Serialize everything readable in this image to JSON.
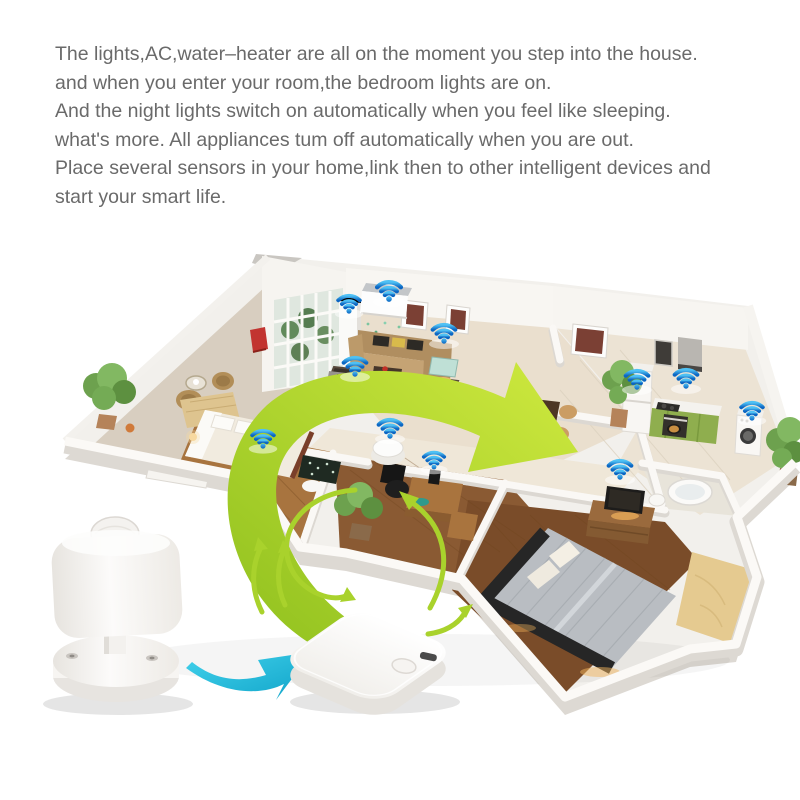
{
  "intro": {
    "lines": [
      "The lights,AC,water–heater are all on the moment you step into the house.",
      "and when you enter your room,the bedroom lights are on.",
      "And the night lights switch on automatically when you feel like sleeping.",
      "what's more. All appliances tum off automatically when you are out.",
      "Place several sensors in your home,link then to other intelligent devices and",
      "start your smart life."
    ]
  },
  "scene": {
    "colors": {
      "green_dark": "#8fc01e",
      "green_light": "#cfe93f",
      "green_stroke": "#a9d22c",
      "cyan_dark": "#0fa3c8",
      "cyan_light": "#43d2ec",
      "wifi_dark": "#0b66c3",
      "wifi_light": "#4fc1f4",
      "text_gray": "#6a6a6a"
    },
    "wifi_points": [
      {
        "x": 349,
        "y": 311,
        "s": 0.95
      },
      {
        "x": 389,
        "y": 299,
        "s": 1.05
      },
      {
        "x": 444,
        "y": 341,
        "s": 1.0
      },
      {
        "x": 355,
        "y": 374,
        "s": 1.0
      },
      {
        "x": 263,
        "y": 446,
        "s": 0.95
      },
      {
        "x": 390,
        "y": 436,
        "s": 1.0
      },
      {
        "x": 434,
        "y": 467,
        "s": 0.9
      },
      {
        "x": 637,
        "y": 387,
        "s": 1.0
      },
      {
        "x": 686,
        "y": 386,
        "s": 1.0
      },
      {
        "x": 752,
        "y": 418,
        "s": 0.95
      },
      {
        "x": 620,
        "y": 477,
        "s": 1.0
      }
    ],
    "icons": {
      "wifi": "wifi-signal-icon",
      "sensor": "pir-motion-sensor-device",
      "hub": "smart-gateway-hub-device",
      "arrow_big": "green-arrow-to-dining",
      "arrow_office": "green-arrow-to-office",
      "arrow_loop": "green-loop-arrow-hub",
      "arrow_up": "green-double-arrow-up",
      "arrow_hub_right": "green-arrow-hub-to-house",
      "arrow_cyan": "cyan-arrow-sensor-to-hub"
    }
  }
}
